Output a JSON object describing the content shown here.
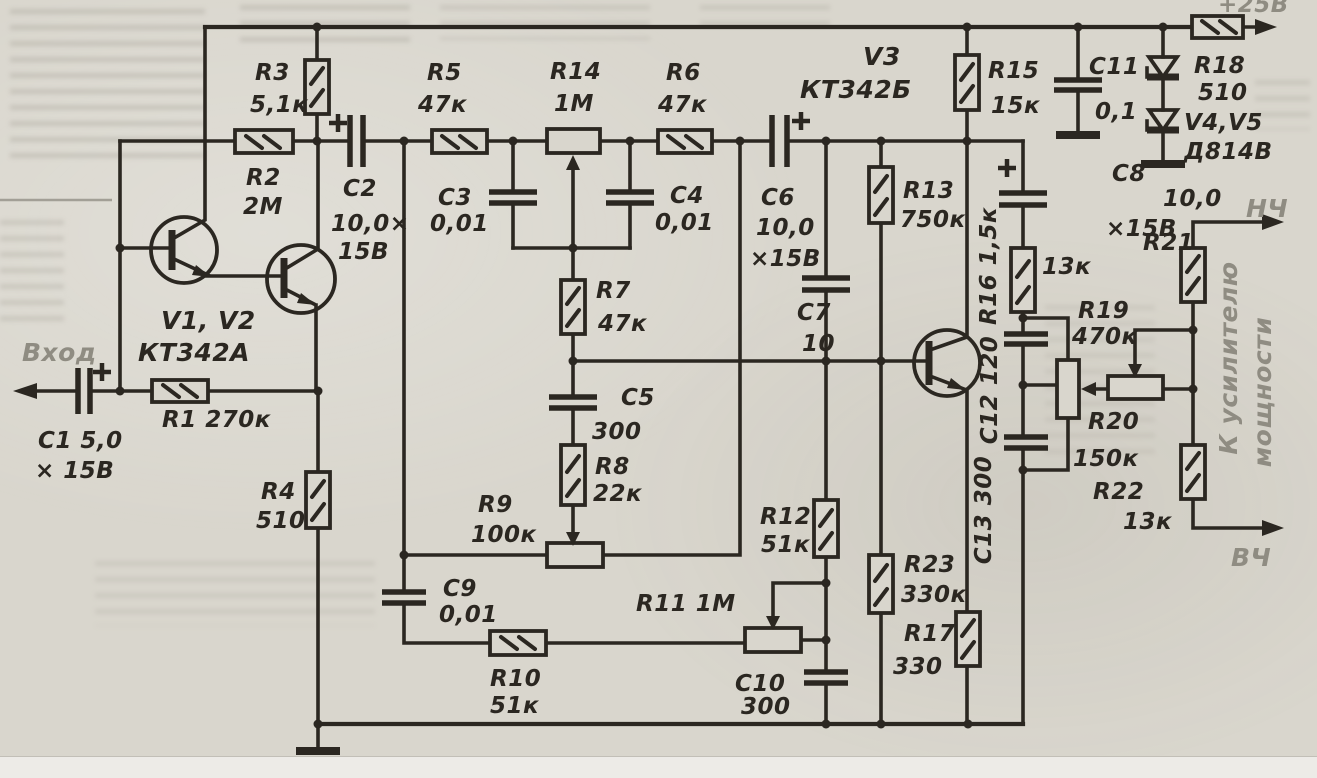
{
  "power": {
    "rail_label": "+25В"
  },
  "io": {
    "input": "Вход",
    "lf": "НЧ",
    "hf": "ВЧ",
    "dest_line1": "К усилителю",
    "dest_line2": "мощности"
  },
  "semiconductors": {
    "v1v2": {
      "name": "V1, V2",
      "type": "КТ342А"
    },
    "v3": {
      "name": "V3",
      "type": "КТ342Б"
    },
    "v4v5": {
      "name": "V4,V5",
      "type": "Д814В"
    }
  },
  "resistors": {
    "r1": {
      "label": "R1 270к"
    },
    "r2": {
      "name": "R2",
      "value": "2М"
    },
    "r3": {
      "name": "R3",
      "value": "5,1к"
    },
    "r4": {
      "name": "R4",
      "value": "510"
    },
    "r5": {
      "name": "R5",
      "value": "47к"
    },
    "r6": {
      "name": "R6",
      "value": "47к"
    },
    "r7": {
      "name": "R7",
      "value": "47к"
    },
    "r8": {
      "name": "R8",
      "value": "22к"
    },
    "r9": {
      "name": "R9",
      "value": "100к"
    },
    "r10": {
      "name": "R10",
      "value": "51к"
    },
    "r11": {
      "label": "R11 1М"
    },
    "r12": {
      "name": "R12",
      "value": "51к"
    },
    "r13": {
      "name": "R13",
      "value": "750к"
    },
    "r14": {
      "name": "R14",
      "value": "1М"
    },
    "r15": {
      "name": "R15",
      "value": "15к"
    },
    "r16": {
      "label": "R16 1,5к"
    },
    "r17": {
      "name": "R17",
      "value": "330"
    },
    "r18": {
      "name": "R18",
      "value": "510"
    },
    "r19": {
      "name": "R19",
      "value": "470к"
    },
    "r20": {
      "name": "R20",
      "value": "150к"
    },
    "r21": {
      "name": "R21",
      "value": "13к"
    },
    "r22": {
      "name": "R22",
      "value": "13к"
    },
    "r23": {
      "name": "R23",
      "value": "330к"
    }
  },
  "capacitors": {
    "c1": {
      "label1": "C1 5,0",
      "label2": "× 15В"
    },
    "c2": {
      "name": "C2",
      "value": "10,0×",
      "rating": "15В"
    },
    "c3": {
      "name": "C3",
      "value": "0,01"
    },
    "c4": {
      "name": "C4",
      "value": "0,01"
    },
    "c5": {
      "name": "C5",
      "value": "300"
    },
    "c6": {
      "name": "C6",
      "value": "10,0",
      "rating": "×15В"
    },
    "c7": {
      "name": "C7",
      "value": "10"
    },
    "c8": {
      "name": "C8",
      "value": "10,0",
      "rating": "×15В"
    },
    "c9": {
      "name": "C9",
      "value": "0,01"
    },
    "c10": {
      "name": "C10",
      "value": "300"
    },
    "c11": {
      "name": "C11",
      "value": "0,1"
    },
    "c12": {
      "label": "С12 120"
    },
    "c13": {
      "label": "С13 300"
    }
  },
  "colors": {
    "ink": "#2b2721",
    "paper": "#d9d6cd",
    "faded_label": "#8f8c82"
  }
}
